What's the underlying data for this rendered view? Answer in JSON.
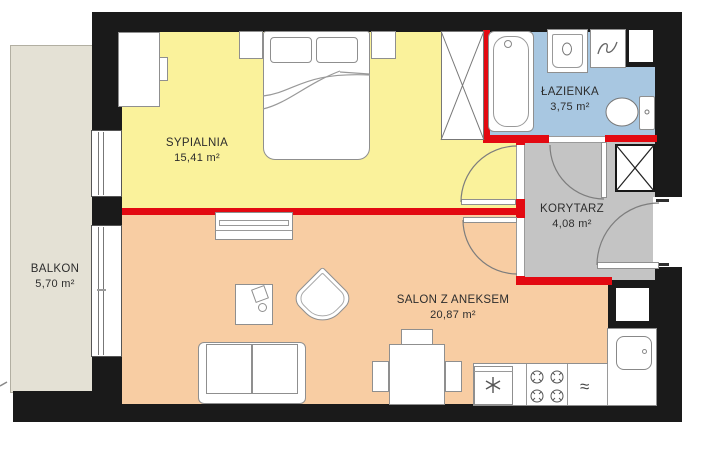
{
  "rooms": {
    "bedroom": {
      "name": "SYPIALNIA",
      "area": "15,41 m²"
    },
    "bathroom": {
      "name": "ŁAZIENKA",
      "area": "3,75 m²"
    },
    "corridor": {
      "name": "KORYTARZ",
      "area": "4,08 m²"
    },
    "living_room": {
      "name": "SALON Z ANEKSEM",
      "area": "20,87 m²"
    },
    "balcony": {
      "name": "BALKON",
      "area": "5,70 m²"
    }
  },
  "symbols": {
    "dishwasher": "≈"
  },
  "colors": {
    "bedroom_floor": "#FAF29B",
    "living_floor": "#F8CDA3",
    "bathroom_floor": "#A8C7E1",
    "corridor_floor": "#C4C4C4",
    "balcony_floor": "#E4E1D5",
    "load_bearing_wall": "#1A1A1A",
    "partition_wall": "#E30911"
  }
}
